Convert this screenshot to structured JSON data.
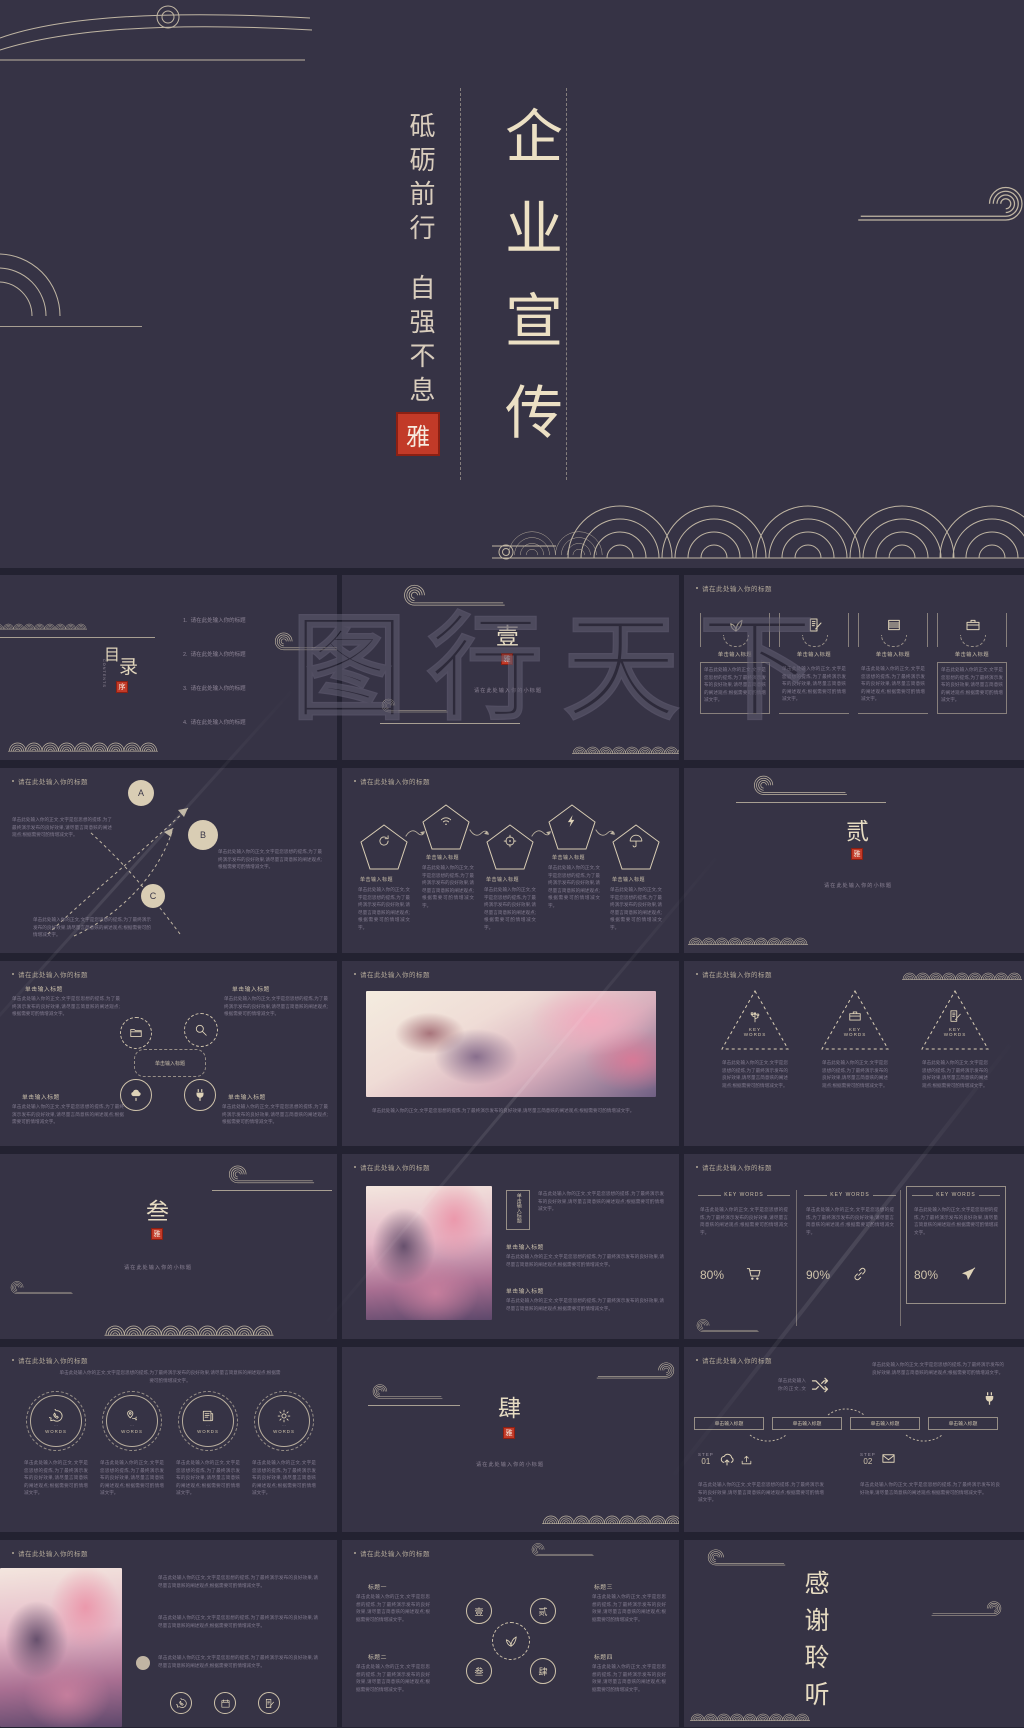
{
  "colors": {
    "background": "#363345",
    "page_gap": "#232231",
    "line_art": "#dfd3b8",
    "seal_red": "#c23a28",
    "body_text": "#837c90",
    "title_text": "#b3a999",
    "watermark": "#6e6980"
  },
  "cover": {
    "motto_top": "砥砺前行",
    "motto_bottom": "自强不息",
    "seal": "雅",
    "title": "企业宣传"
  },
  "watermark_text": "图行天下",
  "common": {
    "slide_title": "请在此处输入你的标题",
    "section_subtitle": "请在此处输入你的小标题",
    "item_title": "单击输入标题",
    "body": "单击此处输入你的正文,文字是您思想的提炼,为了最终演示发布的良好效果,请尽量言简意赅的阐述观点;根据需要可酌情增减文字。",
    "body_short": "单击此处输入你的正文,文字是您思想的提炼。"
  },
  "toc": {
    "char_top": "目",
    "char_bottom": "录",
    "subtitle": "CONTENTS",
    "seal": "序",
    "numbers": [
      "1.",
      "2.",
      "3.",
      "4."
    ]
  },
  "sections": {
    "one": "壹",
    "two": "贰",
    "three": "叁",
    "four": "肆",
    "seal": "雅"
  },
  "keywords": {
    "label": "KEY WORDS",
    "percents": [
      "80%",
      "90%",
      "80%"
    ]
  },
  "words": {
    "label": "WORDS"
  },
  "steps": {
    "label": "STEP",
    "num1": "01",
    "num2": "02"
  },
  "flow": {
    "labels": [
      "标题一",
      "标题二",
      "标题三",
      "标题四"
    ],
    "chars": [
      "壹",
      "贰",
      "叁",
      "肆"
    ]
  },
  "thanks": "感谢聆听"
}
